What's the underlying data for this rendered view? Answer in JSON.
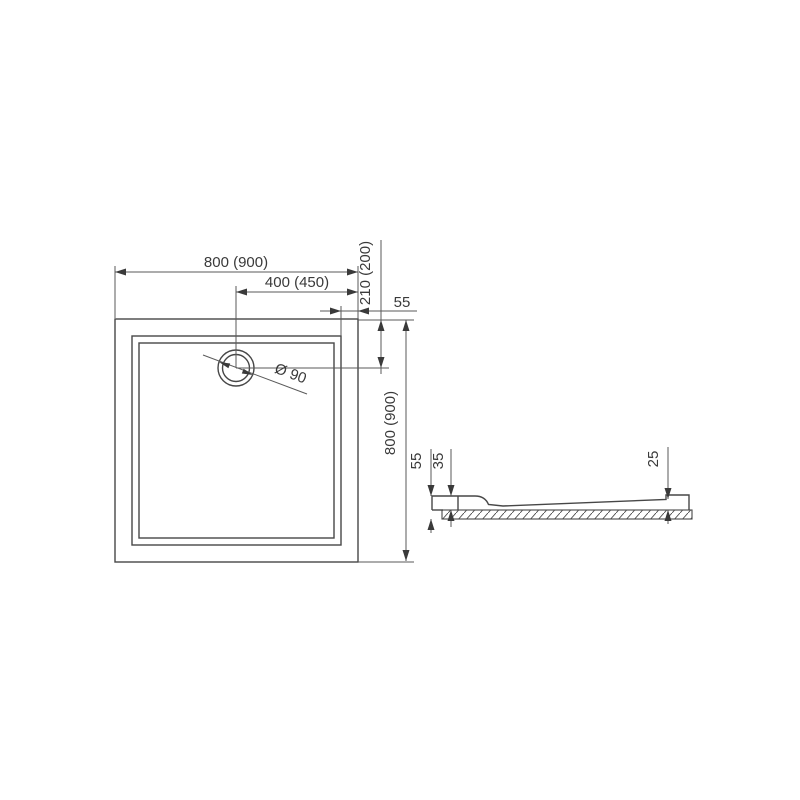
{
  "drawing": {
    "plan": {
      "width": "800 (900)",
      "drain_offset_x": "400 (450)",
      "drain_offset_y": "210 (200)",
      "rim_width": "55",
      "height": "800 (900)",
      "drain_diameter": "Ø 90"
    },
    "section": {
      "total_height": "55",
      "inner_depth": "35",
      "edge_height": "25"
    }
  }
}
